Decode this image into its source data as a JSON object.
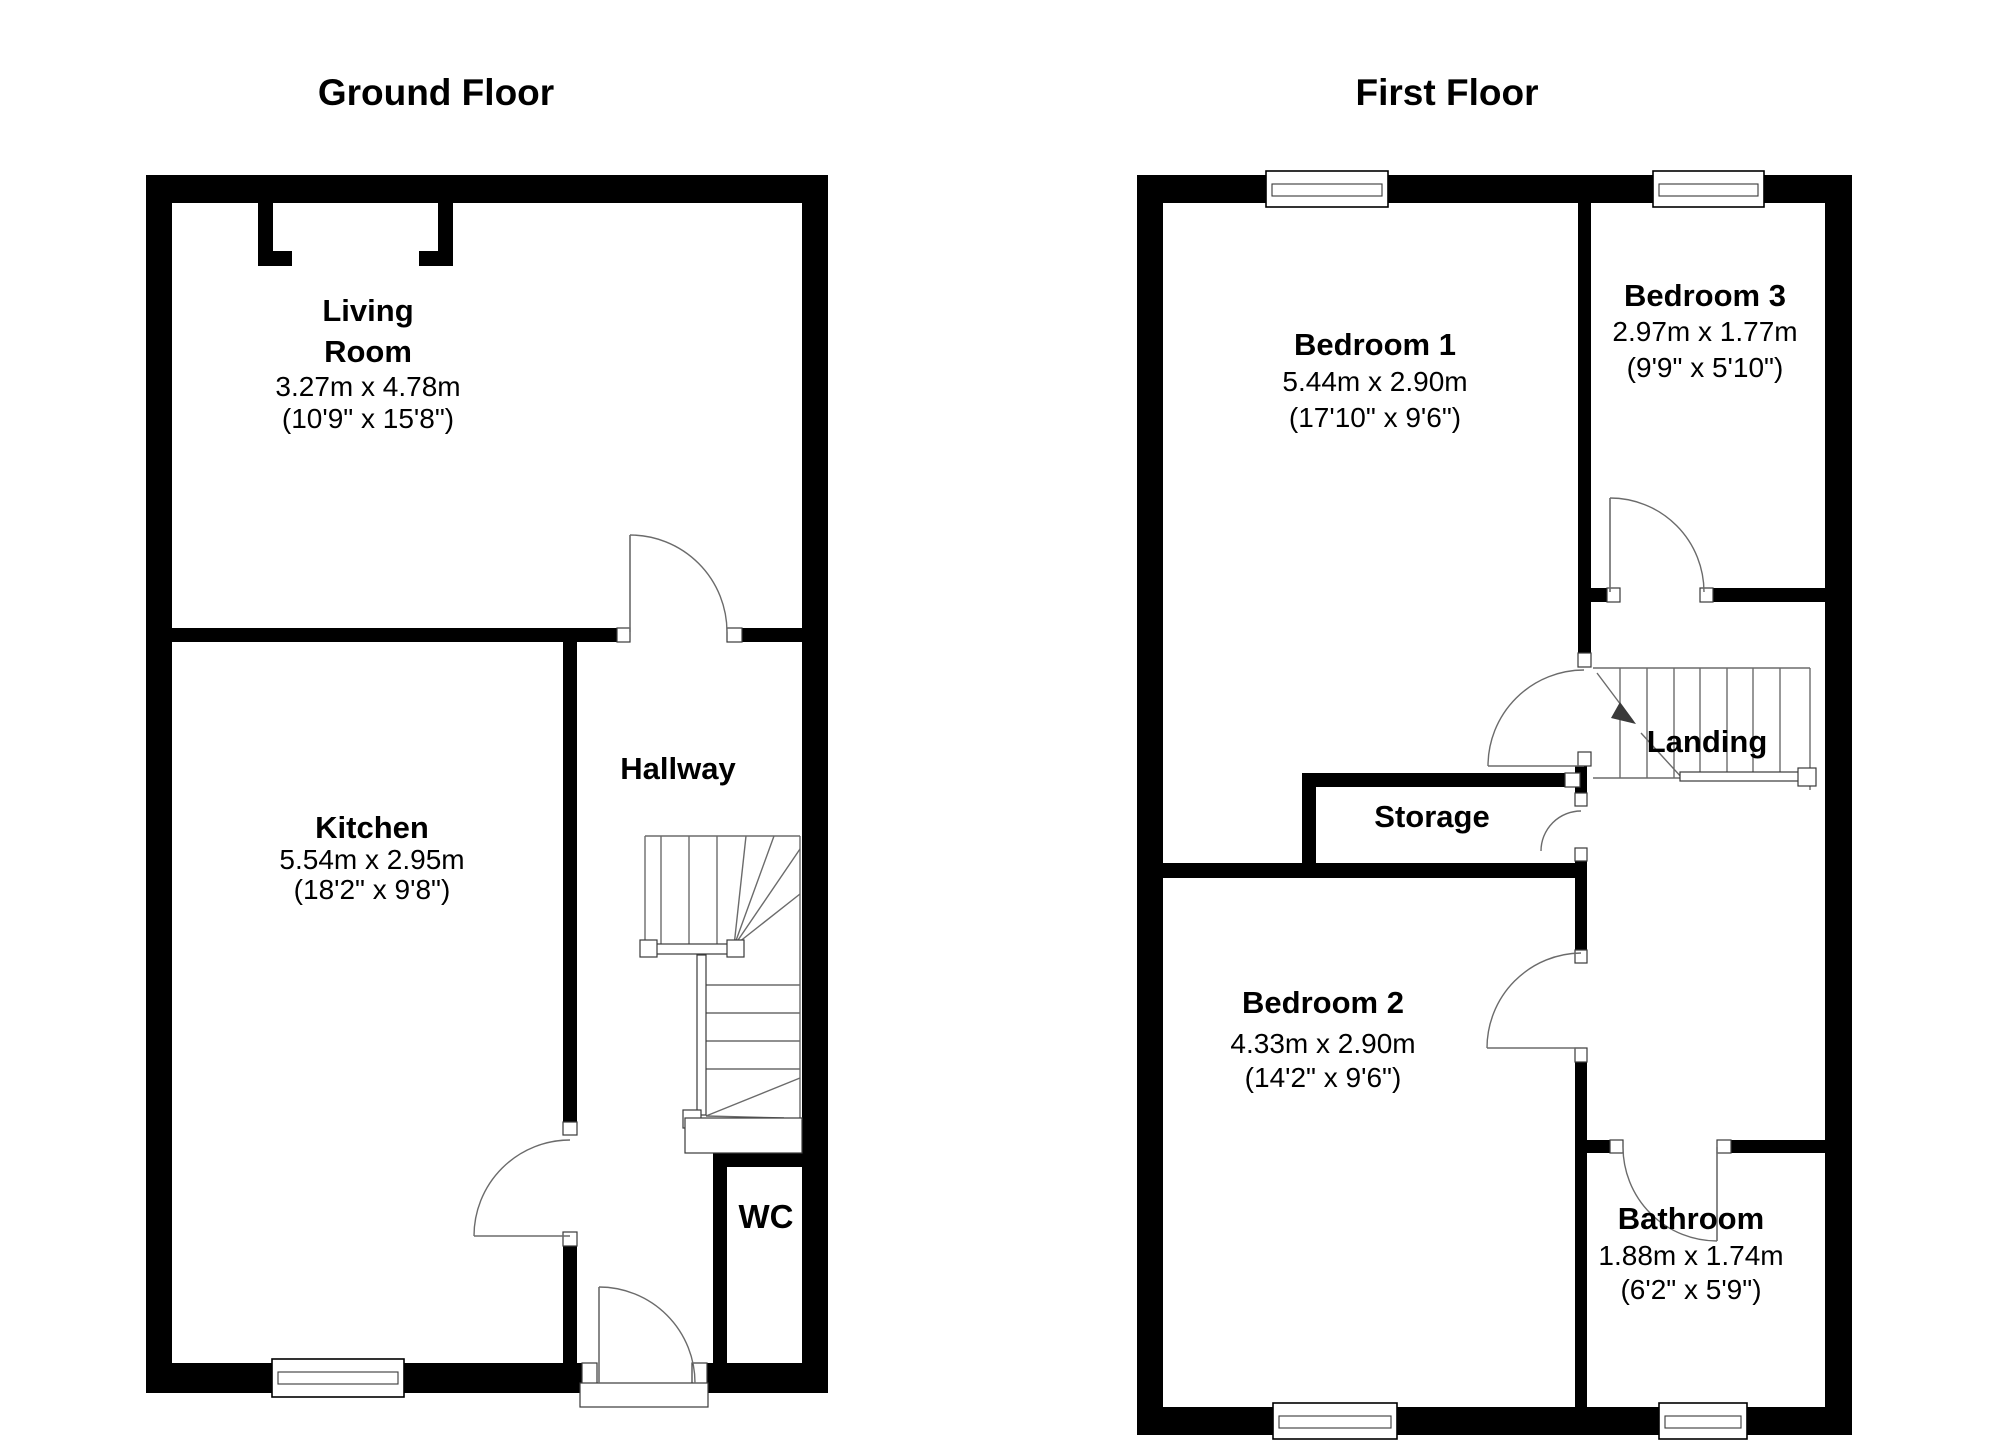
{
  "app": {
    "background": "#ffffff",
    "wall_color": "#000000",
    "detail_line_color": "#6b6b6b",
    "frame_stroke": "#3a3a3a",
    "text_color": "#000000"
  },
  "floors": [
    {
      "id": "ground-floor",
      "title": {
        "text": "Ground Floor",
        "cx": 436
      },
      "walls": [
        [
          146,
          175,
          682,
          28
        ],
        [
          146,
          203,
          26,
          1190
        ],
        [
          802,
          203,
          26,
          1190
        ],
        [
          146,
          1363,
          436,
          30
        ],
        [
          707,
          1363,
          121,
          30
        ],
        [
          258,
          203,
          15,
          63
        ],
        [
          258,
          251,
          34,
          15
        ],
        [
          438,
          203,
          15,
          63
        ],
        [
          419,
          251,
          34,
          15
        ],
        [
          172,
          628,
          445,
          14
        ],
        [
          742,
          628,
          60,
          14
        ],
        [
          563,
          642,
          14,
          480
        ],
        [
          563,
          1246,
          14,
          117
        ],
        [
          713,
          1153,
          89,
          14
        ],
        [
          713,
          1167,
          14,
          196
        ]
      ],
      "frames": [
        [
          617,
          628,
          13,
          14
        ],
        [
          727,
          628,
          15,
          14
        ],
        [
          563,
          1122,
          14,
          13
        ],
        [
          563,
          1232,
          14,
          14
        ],
        [
          582,
          1363,
          15,
          30
        ],
        [
          692,
          1363,
          15,
          30
        ]
      ],
      "windows": [
        {
          "name": "kitchen-window",
          "outer": [
            272,
            1359,
            132,
            38
          ],
          "inner": [
            278,
            1372,
            120,
            12
          ]
        }
      ],
      "doors": [
        {
          "name": "living-room-door",
          "leaf": [
            630,
            632,
            630,
            535
          ],
          "arc": "M 630 535 A 97 97 0 0 1 727 632"
        },
        {
          "name": "kitchen-door",
          "leaf": [
            570,
            1236,
            474,
            1236
          ],
          "arc": "M 474 1236 A 96 96 0 0 1 570 1140"
        },
        {
          "name": "front-door",
          "leaf": [
            599,
            1383,
            599,
            1287
          ],
          "arc": "M 599 1287 A 96 96 0 0 1 695 1383"
        }
      ],
      "stair_lines": [
        [
          645,
          836,
          800,
          836
        ],
        [
          645,
          836,
          645,
          946
        ],
        [
          661,
          836,
          661,
          946
        ],
        [
          689,
          836,
          689,
          946
        ],
        [
          717,
          836,
          717,
          946
        ],
        [
          800,
          836,
          800,
          946
        ],
        [
          734,
          946,
          746,
          836
        ],
        [
          734,
          946,
          774,
          836
        ],
        [
          734,
          946,
          800,
          849
        ],
        [
          734,
          946,
          800,
          894
        ],
        [
          706,
          985,
          800,
          985
        ],
        [
          706,
          1013,
          800,
          1013
        ],
        [
          706,
          1041,
          800,
          1041
        ],
        [
          706,
          1069,
          800,
          1069
        ],
        [
          800,
          946,
          800,
          1118
        ],
        [
          706,
          1116,
          800,
          1078
        ],
        [
          706,
          1116,
          784,
          1118
        ]
      ],
      "detail_rects": [
        [
          647,
          944,
          90,
          10
        ],
        [
          640,
          940,
          17,
          17
        ],
        [
          727,
          940,
          17,
          17
        ],
        [
          697,
          955,
          9,
          160
        ],
        [
          683,
          1110,
          18,
          18
        ],
        [
          685,
          1118,
          117,
          35
        ],
        [
          580,
          1383,
          128,
          24
        ]
      ],
      "arrows": [],
      "labels": [
        {
          "name": "living-room-label",
          "cx": 368,
          "lines": [
            {
              "text": "Living",
              "bold": true,
              "y": 321
            },
            {
              "text": "Room",
              "bold": true,
              "y": 362
            },
            {
              "text": "3.27m x 4.78m",
              "bold": false,
              "y": 396
            },
            {
              "text": "(10'9\" x 15'8\")",
              "bold": false,
              "y": 428
            }
          ]
        },
        {
          "name": "kitchen-label",
          "cx": 372,
          "lines": [
            {
              "text": "Kitchen",
              "bold": true,
              "y": 838
            },
            {
              "text": "5.54m x 2.95m",
              "bold": false,
              "y": 869
            },
            {
              "text": "(18'2\" x 9'8\")",
              "bold": false,
              "y": 899
            }
          ]
        },
        {
          "name": "hallway-label",
          "cx": 678,
          "lines": [
            {
              "text": "Hallway",
              "bold": true,
              "y": 779
            }
          ]
        },
        {
          "name": "wc-label",
          "cx": 766,
          "lines": [
            {
              "text": "WC",
              "bold": true,
              "y": 1228,
              "size": 33
            }
          ]
        }
      ]
    },
    {
      "id": "first-floor",
      "title": {
        "text": "First Floor",
        "cx": 1447
      },
      "walls": [
        [
          1137,
          175,
          715,
          28
        ],
        [
          1137,
          203,
          26,
          1232
        ],
        [
          1825,
          203,
          27,
          1232
        ],
        [
          1137,
          1407,
          715,
          28
        ],
        [
          1578,
          203,
          13,
          450
        ],
        [
          1578,
          588,
          29,
          14
        ],
        [
          1713,
          588,
          112,
          14
        ],
        [
          1313,
          773,
          252,
          14
        ],
        [
          1302,
          773,
          14,
          105
        ],
        [
          1163,
          863,
          424,
          15
        ],
        [
          1575,
          766,
          12,
          27
        ],
        [
          1575,
          861,
          12,
          89
        ],
        [
          1575,
          1062,
          12,
          345
        ],
        [
          1587,
          1140,
          23,
          13
        ],
        [
          1731,
          1140,
          94,
          13
        ]
      ],
      "frames": [
        [
          1578,
          653,
          13,
          14
        ],
        [
          1578,
          752,
          13,
          14
        ],
        [
          1565,
          773,
          15,
          14
        ],
        [
          1575,
          793,
          12,
          13
        ],
        [
          1575,
          848,
          12,
          13
        ],
        [
          1575,
          950,
          12,
          13
        ],
        [
          1575,
          1048,
          12,
          14
        ],
        [
          1610,
          1140,
          13,
          13
        ],
        [
          1717,
          1140,
          14,
          13
        ],
        [
          1607,
          588,
          13,
          14
        ],
        [
          1700,
          588,
          13,
          14
        ]
      ],
      "windows": [
        {
          "name": "bedroom1-window",
          "outer": [
            1266,
            171,
            122,
            36
          ],
          "inner": [
            1272,
            184,
            110,
            12
          ]
        },
        {
          "name": "bedroom3-window",
          "outer": [
            1653,
            171,
            111,
            36
          ],
          "inner": [
            1659,
            184,
            99,
            12
          ]
        },
        {
          "name": "bedroom2-window",
          "outer": [
            1273,
            1403,
            124,
            36
          ],
          "inner": [
            1279,
            1416,
            112,
            12
          ]
        },
        {
          "name": "bathroom-window",
          "outer": [
            1659,
            1403,
            88,
            36
          ],
          "inner": [
            1665,
            1416,
            76,
            12
          ]
        }
      ],
      "doors": [
        {
          "name": "bedroom1-door",
          "leaf": [
            1584,
            766,
            1488,
            766
          ],
          "arc": "M 1584 670 A 96 96 0 0 0 1488 766"
        },
        {
          "name": "storage-door",
          "leaf": null,
          "arc": "M 1581 811 A 40 40 0 0 0 1541 851"
        },
        {
          "name": "bedroom2-door",
          "leaf": [
            1581,
            1048,
            1487,
            1048
          ],
          "arc": "M 1581 953 A 95 95 0 0 0 1487 1048"
        },
        {
          "name": "bathroom-door",
          "leaf": [
            1717,
            1147,
            1717,
            1241
          ],
          "arc": "M 1623 1147 A 94 94 0 0 0 1717 1241"
        },
        {
          "name": "bedroom3-door",
          "leaf": [
            1610,
            592,
            1610,
            498
          ],
          "arc": "M 1610 498 A 94 94 0 0 1 1704 592"
        }
      ],
      "stair_lines": [
        [
          1593,
          668,
          1810,
          668
        ],
        [
          1593,
          778,
          1810,
          778
        ],
        [
          1620,
          668,
          1620,
          778
        ],
        [
          1647,
          668,
          1647,
          778
        ],
        [
          1674,
          668,
          1674,
          778
        ],
        [
          1700,
          668,
          1700,
          778
        ],
        [
          1727,
          668,
          1727,
          778
        ],
        [
          1753,
          668,
          1753,
          778
        ],
        [
          1780,
          668,
          1780,
          778
        ],
        [
          1810,
          668,
          1810,
          790
        ],
        [
          1597,
          673,
          1633,
          721
        ],
        [
          1641,
          733,
          1683,
          779
        ]
      ],
      "detail_rects": [
        [
          1680,
          772,
          122,
          9
        ],
        [
          1798,
          768,
          18,
          18
        ]
      ],
      "arrows": [
        "1636,724 1620,702 1611,718"
      ],
      "labels": [
        {
          "name": "bedroom1-label",
          "cx": 1375,
          "lines": [
            {
              "text": "Bedroom 1",
              "bold": true,
              "y": 355
            },
            {
              "text": "5.44m x 2.90m",
              "bold": false,
              "y": 391
            },
            {
              "text": "(17'10\" x 9'6\")",
              "bold": false,
              "y": 427
            }
          ]
        },
        {
          "name": "bedroom3-label",
          "cx": 1705,
          "lines": [
            {
              "text": "Bedroom 3",
              "bold": true,
              "y": 306
            },
            {
              "text": "2.97m x 1.77m",
              "bold": false,
              "y": 341
            },
            {
              "text": "(9'9\" x 5'10\")",
              "bold": false,
              "y": 377
            }
          ]
        },
        {
          "name": "landing-label",
          "cx": 1707,
          "lines": [
            {
              "text": "Landing",
              "bold": true,
              "y": 752
            }
          ]
        },
        {
          "name": "storage-label",
          "cx": 1432,
          "lines": [
            {
              "text": "Storage",
              "bold": true,
              "y": 827
            }
          ]
        },
        {
          "name": "bedroom2-label",
          "cx": 1323,
          "lines": [
            {
              "text": "Bedroom 2",
              "bold": true,
              "y": 1013
            },
            {
              "text": "4.33m x 2.90m",
              "bold": false,
              "y": 1053
            },
            {
              "text": "(14'2\" x 9'6\")",
              "bold": false,
              "y": 1087
            }
          ]
        },
        {
          "name": "bathroom-label",
          "cx": 1691,
          "lines": [
            {
              "text": "Bathroom",
              "bold": true,
              "y": 1229
            },
            {
              "text": "1.88m x 1.74m",
              "bold": false,
              "y": 1265
            },
            {
              "text": "(6'2\" x 5'9\")",
              "bold": false,
              "y": 1299
            }
          ]
        }
      ]
    }
  ]
}
